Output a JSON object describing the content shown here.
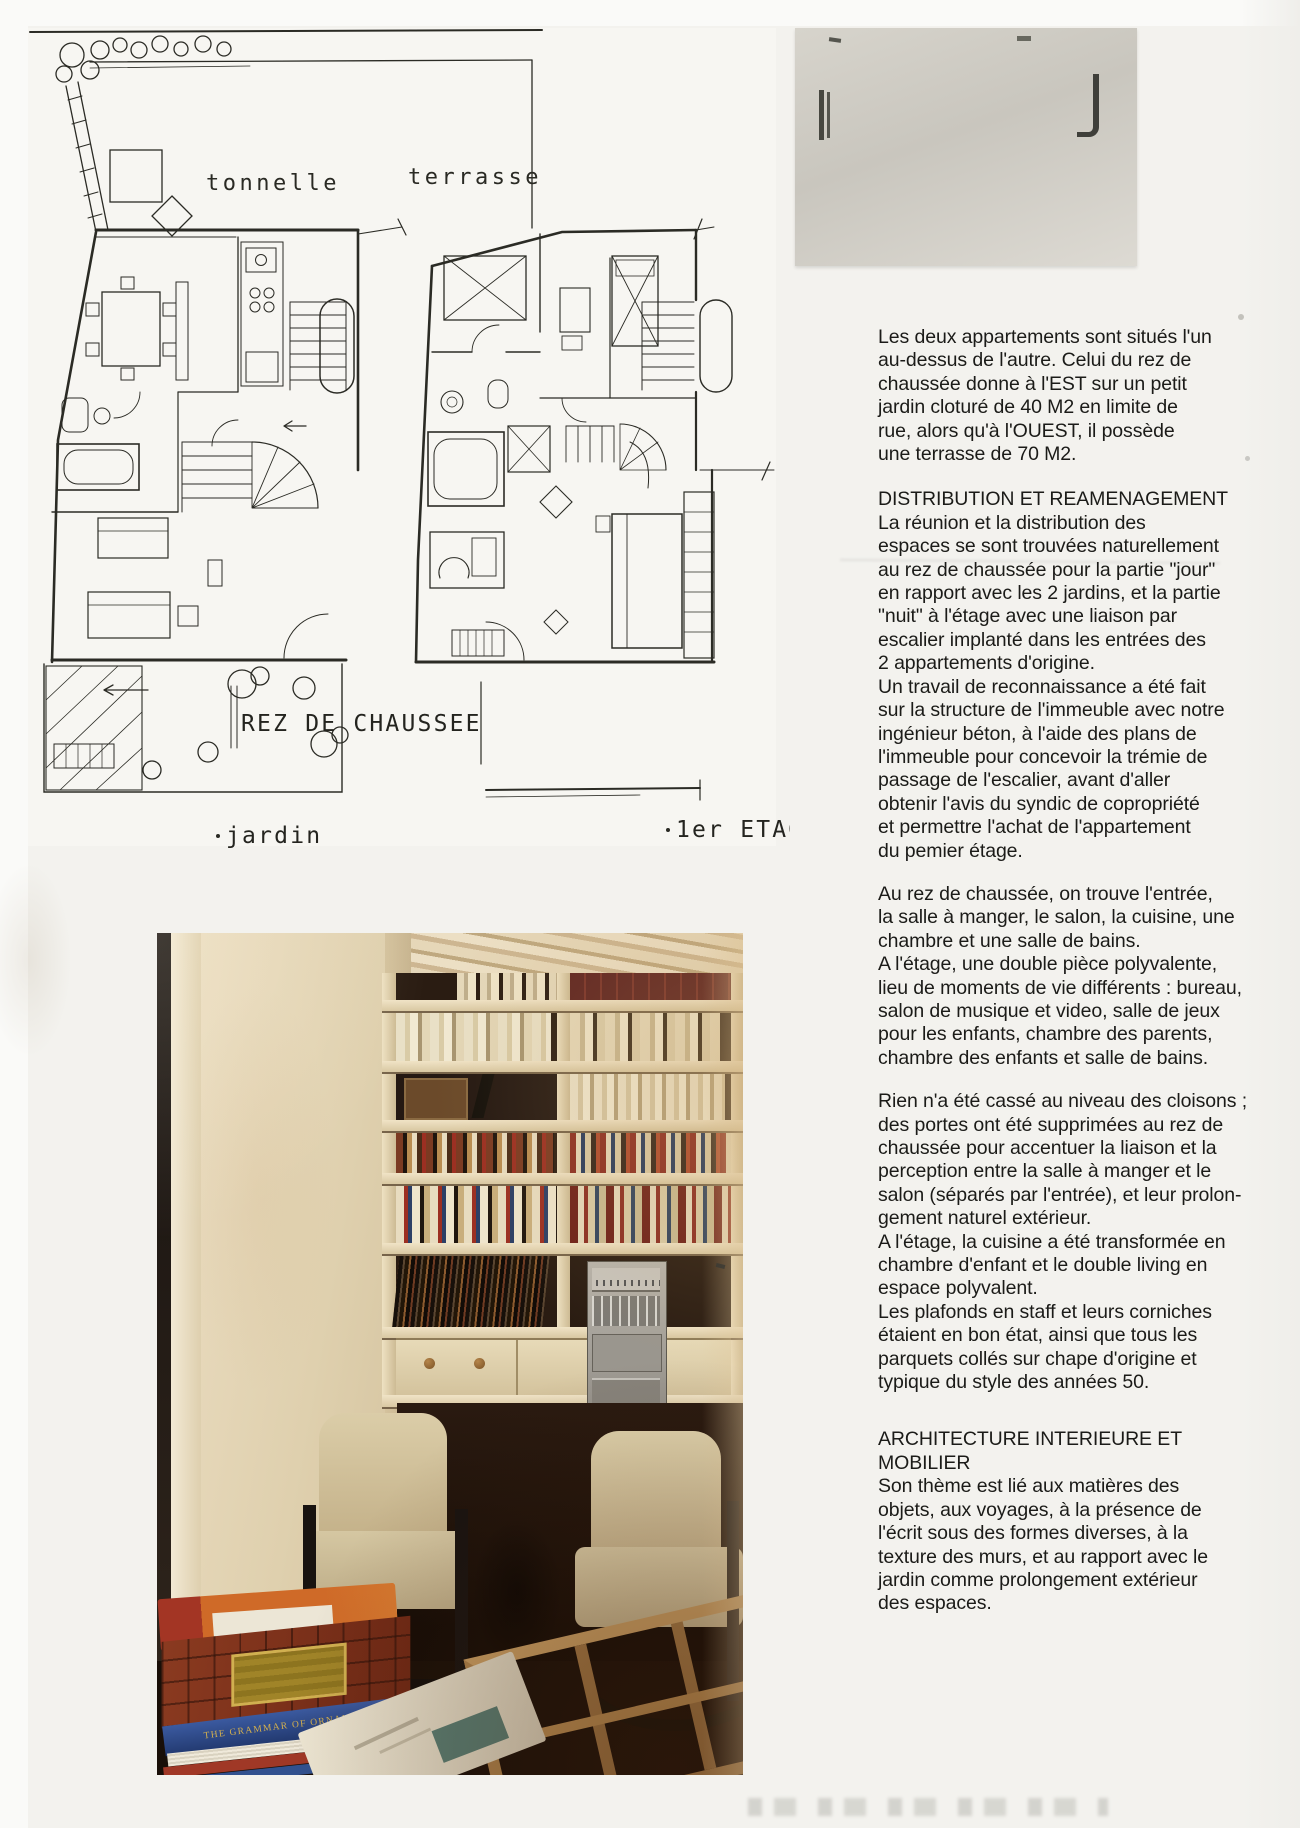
{
  "plans": {
    "labels": {
      "tonnelle": "tonnelle",
      "terrasse": "terrasse",
      "ground_title": "REZ DE CHAUSSEE",
      "jardin": "jardin",
      "first_title": "1er ETAGE"
    }
  },
  "article": {
    "sections": [
      {
        "heading": "",
        "body": "Les deux appartements sont situés l'un\nau-dessus de l'autre. Celui du rez de\nchaussée donne à l'EST sur un petit\njardin cloturé de 40 M2 en limite de\nrue, alors qu'à l'OUEST, il possède\nune terrasse de 70 M2."
      },
      {
        "heading": "DISTRIBUTION ET REAMENAGEMENT",
        "body": "La réunion et la distribution des\nespaces se sont trouvées naturellement\nau rez de chaussée pour la partie \"jour\"\nen rapport avec les 2 jardins, et la partie\n\"nuit\" à l'étage avec une liaison par\nescalier implanté dans les entrées des\n2 appartements d'origine.\nUn travail de reconnaissance a été fait\nsur la structure de l'immeuble avec notre\ningénieur béton, à l'aide des plans de\nl'immeuble pour concevoir la trémie de\npassage de l'escalier, avant d'aller\nobtenir l'avis du syndic de copropriété\net permettre l'achat de l'appartement\ndu pemier étage."
      },
      {
        "heading": "",
        "body": "Au rez de chaussée, on trouve l'entrée,\nla salle à manger, le salon, la cuisine, une\nchambre et une salle de bains.\nA l'étage, une double pièce polyvalente,\nlieu de moments de vie différents : bureau,\nsalon de musique et video, salle de jeux\npour les enfants, chambre des parents,\nchambre des enfants et salle de bains."
      },
      {
        "heading": "",
        "body": "Rien n'a été cassé au niveau des cloisons ;\ndes portes ont été supprimées au rez de\nchaussée pour accentuer la liaison et la\nperception entre la salle à manger et le\nsalon (séparés par l'entrée), et leur prolon-\ngement naturel extérieur.\nA l'étage, la cuisine a été transformée en\nchambre d'enfant et le double living en\nespace polyvalent.\nLes plafonds en staff et leurs corniches\nétaient en bon état, ainsi que tous les\nparquets collés sur chape d'origine et\ntypique du style des années 50."
      },
      {
        "heading": "ARCHITECTURE INTERIEURE ET\nMOBILIER",
        "body": "Son thème est lié aux matières des\nobjets, aux voyages, à la présence de\nl'écrit sous des formes diverses, à la\ntexture des murs, et au rapport avec le\njardin comme prolongement extérieur\ndes espaces."
      }
    ]
  },
  "photo": {
    "book_spine_title": "THE GRAMMAR OF ORNAMENT"
  },
  "colors": {
    "ink": "#23231e",
    "page_bg": "#f3f2ee",
    "gray_sheet": "#d0cdc5",
    "photo_wall": "#e4d6b6",
    "photo_floor": "#1d120a",
    "spine_blue": "#2c477e",
    "spine_gold": "#d6b14e"
  }
}
